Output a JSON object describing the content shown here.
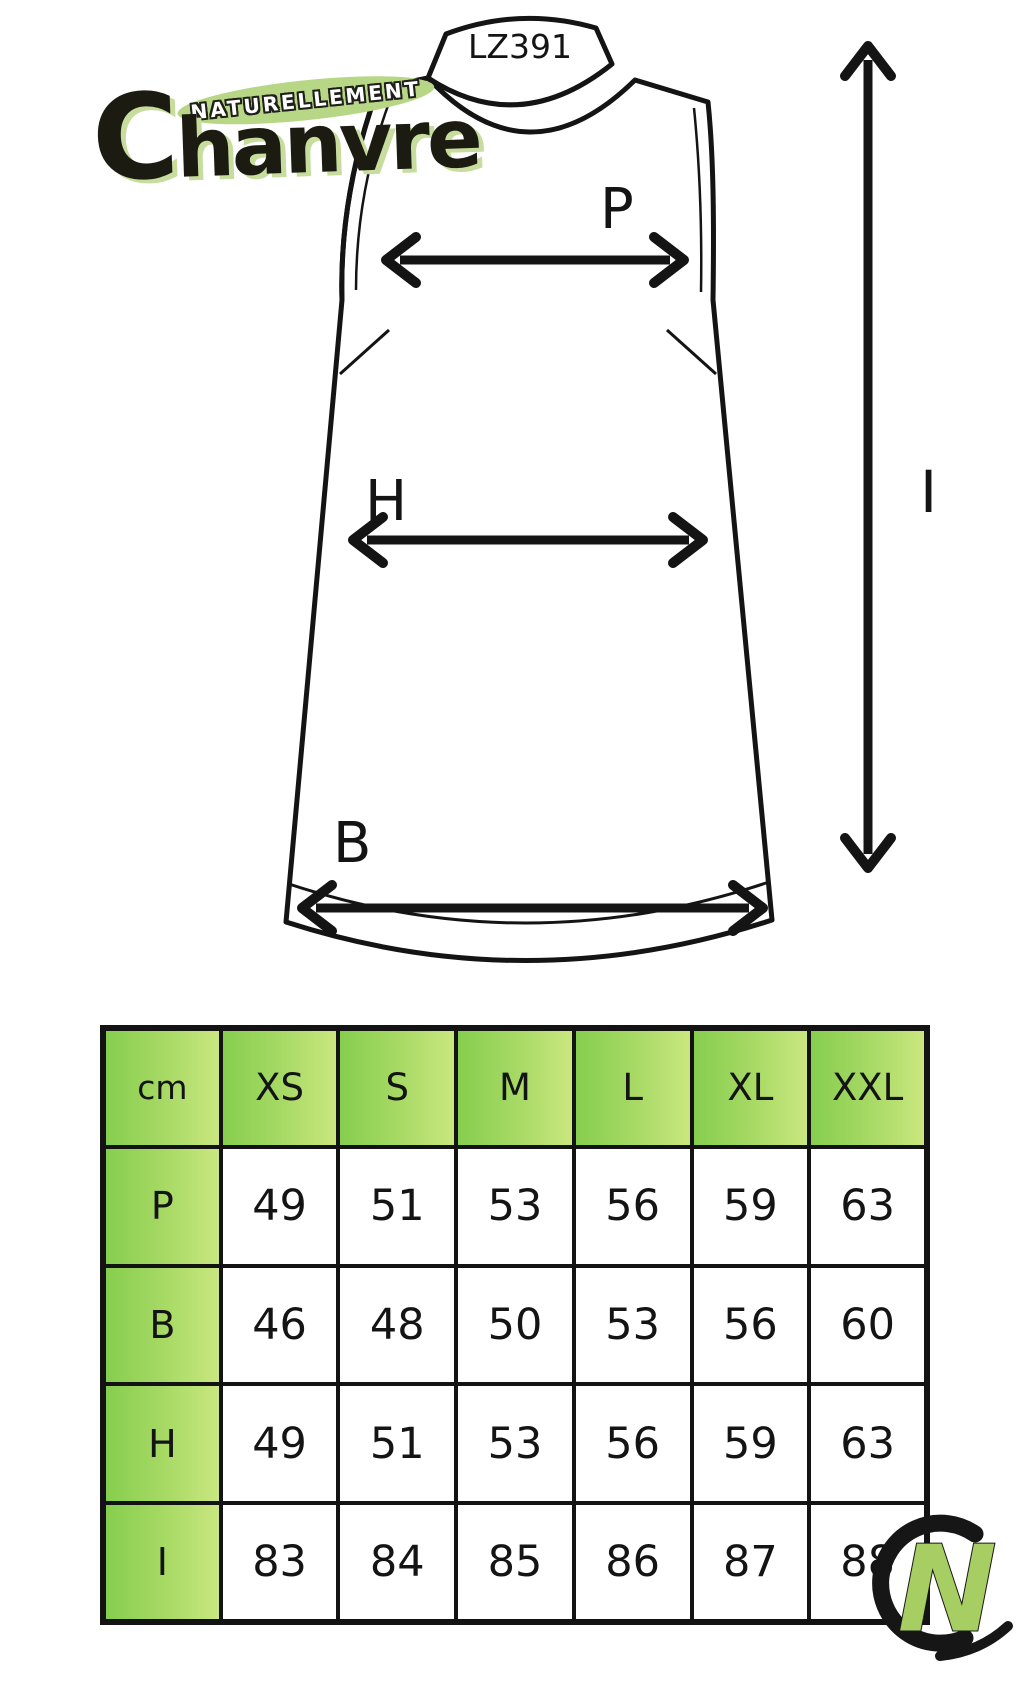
{
  "brand": {
    "tagline": "NATURELLEMENT",
    "name": "Chanvre"
  },
  "garment": {
    "model_code": "LZ391",
    "labels": {
      "chest": "P",
      "hip": "H",
      "bottom": "B",
      "length": "I"
    }
  },
  "size_table": {
    "unit_header": "cm",
    "columns": [
      "XS",
      "S",
      "M",
      "L",
      "XL",
      "XXL"
    ],
    "rows": [
      {
        "label": "P",
        "values": [
          "49",
          "51",
          "53",
          "56",
          "59",
          "63"
        ]
      },
      {
        "label": "B",
        "values": [
          "46",
          "48",
          "50",
          "53",
          "56",
          "60"
        ]
      },
      {
        "label": "H",
        "values": [
          "49",
          "51",
          "53",
          "56",
          "59",
          "63"
        ]
      },
      {
        "label": "I",
        "values": [
          "83",
          "84",
          "85",
          "86",
          "87",
          "88"
        ]
      }
    ]
  },
  "watermark": {
    "letter": "N"
  },
  "colors": {
    "cell_green_start": "#86ce4e",
    "cell_green_end": "#cae77f",
    "logo_pill_green": "#b7d786",
    "logo_shadow_green": "#c7dd9d",
    "line_black": "#141414"
  },
  "chart_data": {
    "type": "table",
    "title": "LZ391 garment measurements (cm)",
    "columns": [
      "cm",
      "XS",
      "S",
      "M",
      "L",
      "XL",
      "XXL"
    ],
    "rows": [
      [
        "P",
        49,
        51,
        53,
        56,
        59,
        63
      ],
      [
        "B",
        46,
        48,
        50,
        53,
        56,
        60
      ],
      [
        "H",
        49,
        51,
        53,
        56,
        59,
        63
      ],
      [
        "I",
        83,
        84,
        85,
        86,
        87,
        88
      ]
    ]
  }
}
